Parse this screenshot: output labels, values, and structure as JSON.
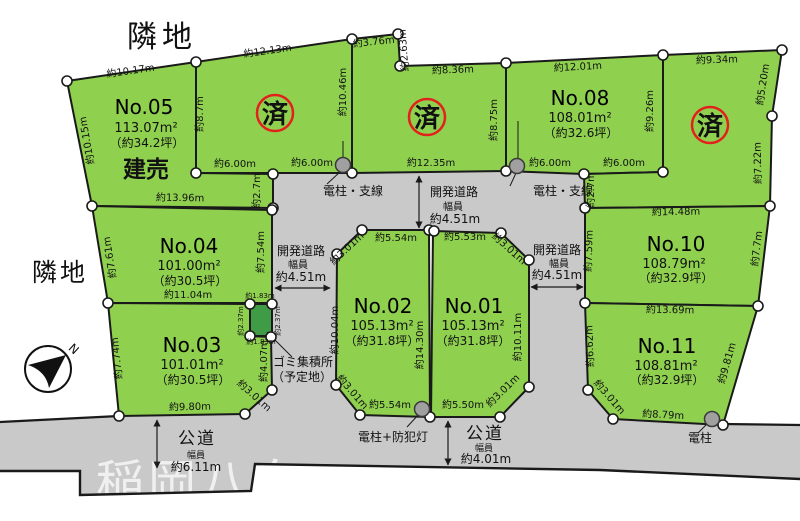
{
  "canvas": {
    "width": 800,
    "height": 521
  },
  "colors": {
    "plot_green": "#8fd04f",
    "garbage_green": "#3f9b45",
    "road_gray": "#c9c9c9",
    "stamp_red": "#e3211c",
    "built_blue": "#1d1ab8"
  },
  "labels": {
    "neighbor_top": "隣地",
    "neighbor_left": "隣地",
    "sold": "済",
    "built_for_sale": "建売",
    "garbage_station": "ゴミ集積所",
    "garbage_station_sub": "（予定地）",
    "pole_wire_left": "電柱・支線",
    "pole_wire_right": "電柱・支線",
    "pole_with_light": "電柱+防犯灯",
    "pole": "電柱",
    "north": "N",
    "watermark": "稲岡八白"
  },
  "roads": {
    "dev_road": {
      "name": "開発道路",
      "width_label": "幅員",
      "width": "約4.51m"
    },
    "public_road_left": {
      "name": "公道",
      "width_label": "幅員",
      "width": "約6.11m"
    },
    "public_road_bottom": {
      "name": "公道",
      "width_label": "幅員",
      "width": "約4.01m"
    }
  },
  "plots": {
    "no01": {
      "name": "No.01",
      "area": "105.13m²",
      "tsubo": "（約31.8坪）"
    },
    "no02": {
      "name": "No.02",
      "area": "105.13m²",
      "tsubo": "（約31.8坪）"
    },
    "no03": {
      "name": "No.03",
      "area": "101.01m²",
      "tsubo": "（約30.5坪）"
    },
    "no04": {
      "name": "No.04",
      "area": "101.00m²",
      "tsubo": "（約30.5坪）"
    },
    "no05": {
      "name": "No.05",
      "area": "113.07m²",
      "tsubo": "（約34.2坪）"
    },
    "no08": {
      "name": "No.08",
      "area": "108.01m²",
      "tsubo": "（約32.6坪）"
    },
    "no10": {
      "name": "No.10",
      "area": "108.79m²",
      "tsubo": "（約32.9坪）"
    },
    "no11": {
      "name": "No.11",
      "area": "108.81m²",
      "tsubo": "（約32.9坪）"
    }
  },
  "measurements": {
    "no05_top": "約10.17m",
    "no05_left": "約10.15m",
    "plotA_top": "約12.13m",
    "plotA_left": "約8.7m",
    "plotA_right": "約10.46m",
    "plotB_nw1": "約3.76m",
    "plotB_nw2": "約2.63m",
    "plotB_top": "約8.36m",
    "plotB_right": "約8.75m",
    "no08_top": "約12.01m",
    "no08_right": "約9.26m",
    "plotC_top": "約9.34m",
    "plotC_right1": "約5.20m",
    "plotC_right2": "約7.22m",
    "seg600_1": "約6.00m",
    "seg600_2": "約6.00m",
    "seg1235": "約12.35m",
    "seg600_3": "約6.00m",
    "seg600_4": "約6.00m",
    "seg27_left": "約2.7m",
    "seg27_right": "約2.7m",
    "no04_top": "約13.96m",
    "no04_left": "約7.61m",
    "no04_right": "約7.54m",
    "no04_bottom": "約11.04m",
    "no03_left": "約7.74m",
    "no03_right": "約4.07m",
    "no03_chamfer": "約3.01m",
    "no03_bottom": "約9.80m",
    "gomi_top": "約1.83m",
    "gomi_left": "約2.37m",
    "gomi_right": "約2.37m",
    "gomi_bottom": "約1.83m",
    "no02_top": "約5.54m",
    "no02_nw": "約3.01m",
    "no02_left": "約10.04m",
    "no02_sw": "約3.01m",
    "no02_bottom": "約5.54m",
    "divider": "約14.30m",
    "no01_top": "約5.53m",
    "no01_ne": "約3.01m",
    "no01_right": "約10.11m",
    "no01_se": "約3.01m",
    "no01_bottom": "約5.50m",
    "no10_top": "約14.48m",
    "no10_left": "約7.59m",
    "no10_right": "約7.7m",
    "no10_bottom": "約13.69m",
    "no11_left": "約6.62m",
    "no11_right": "約9.81m",
    "no11_sw": "約3.01m",
    "no11_bottom": "約8.79m"
  }
}
